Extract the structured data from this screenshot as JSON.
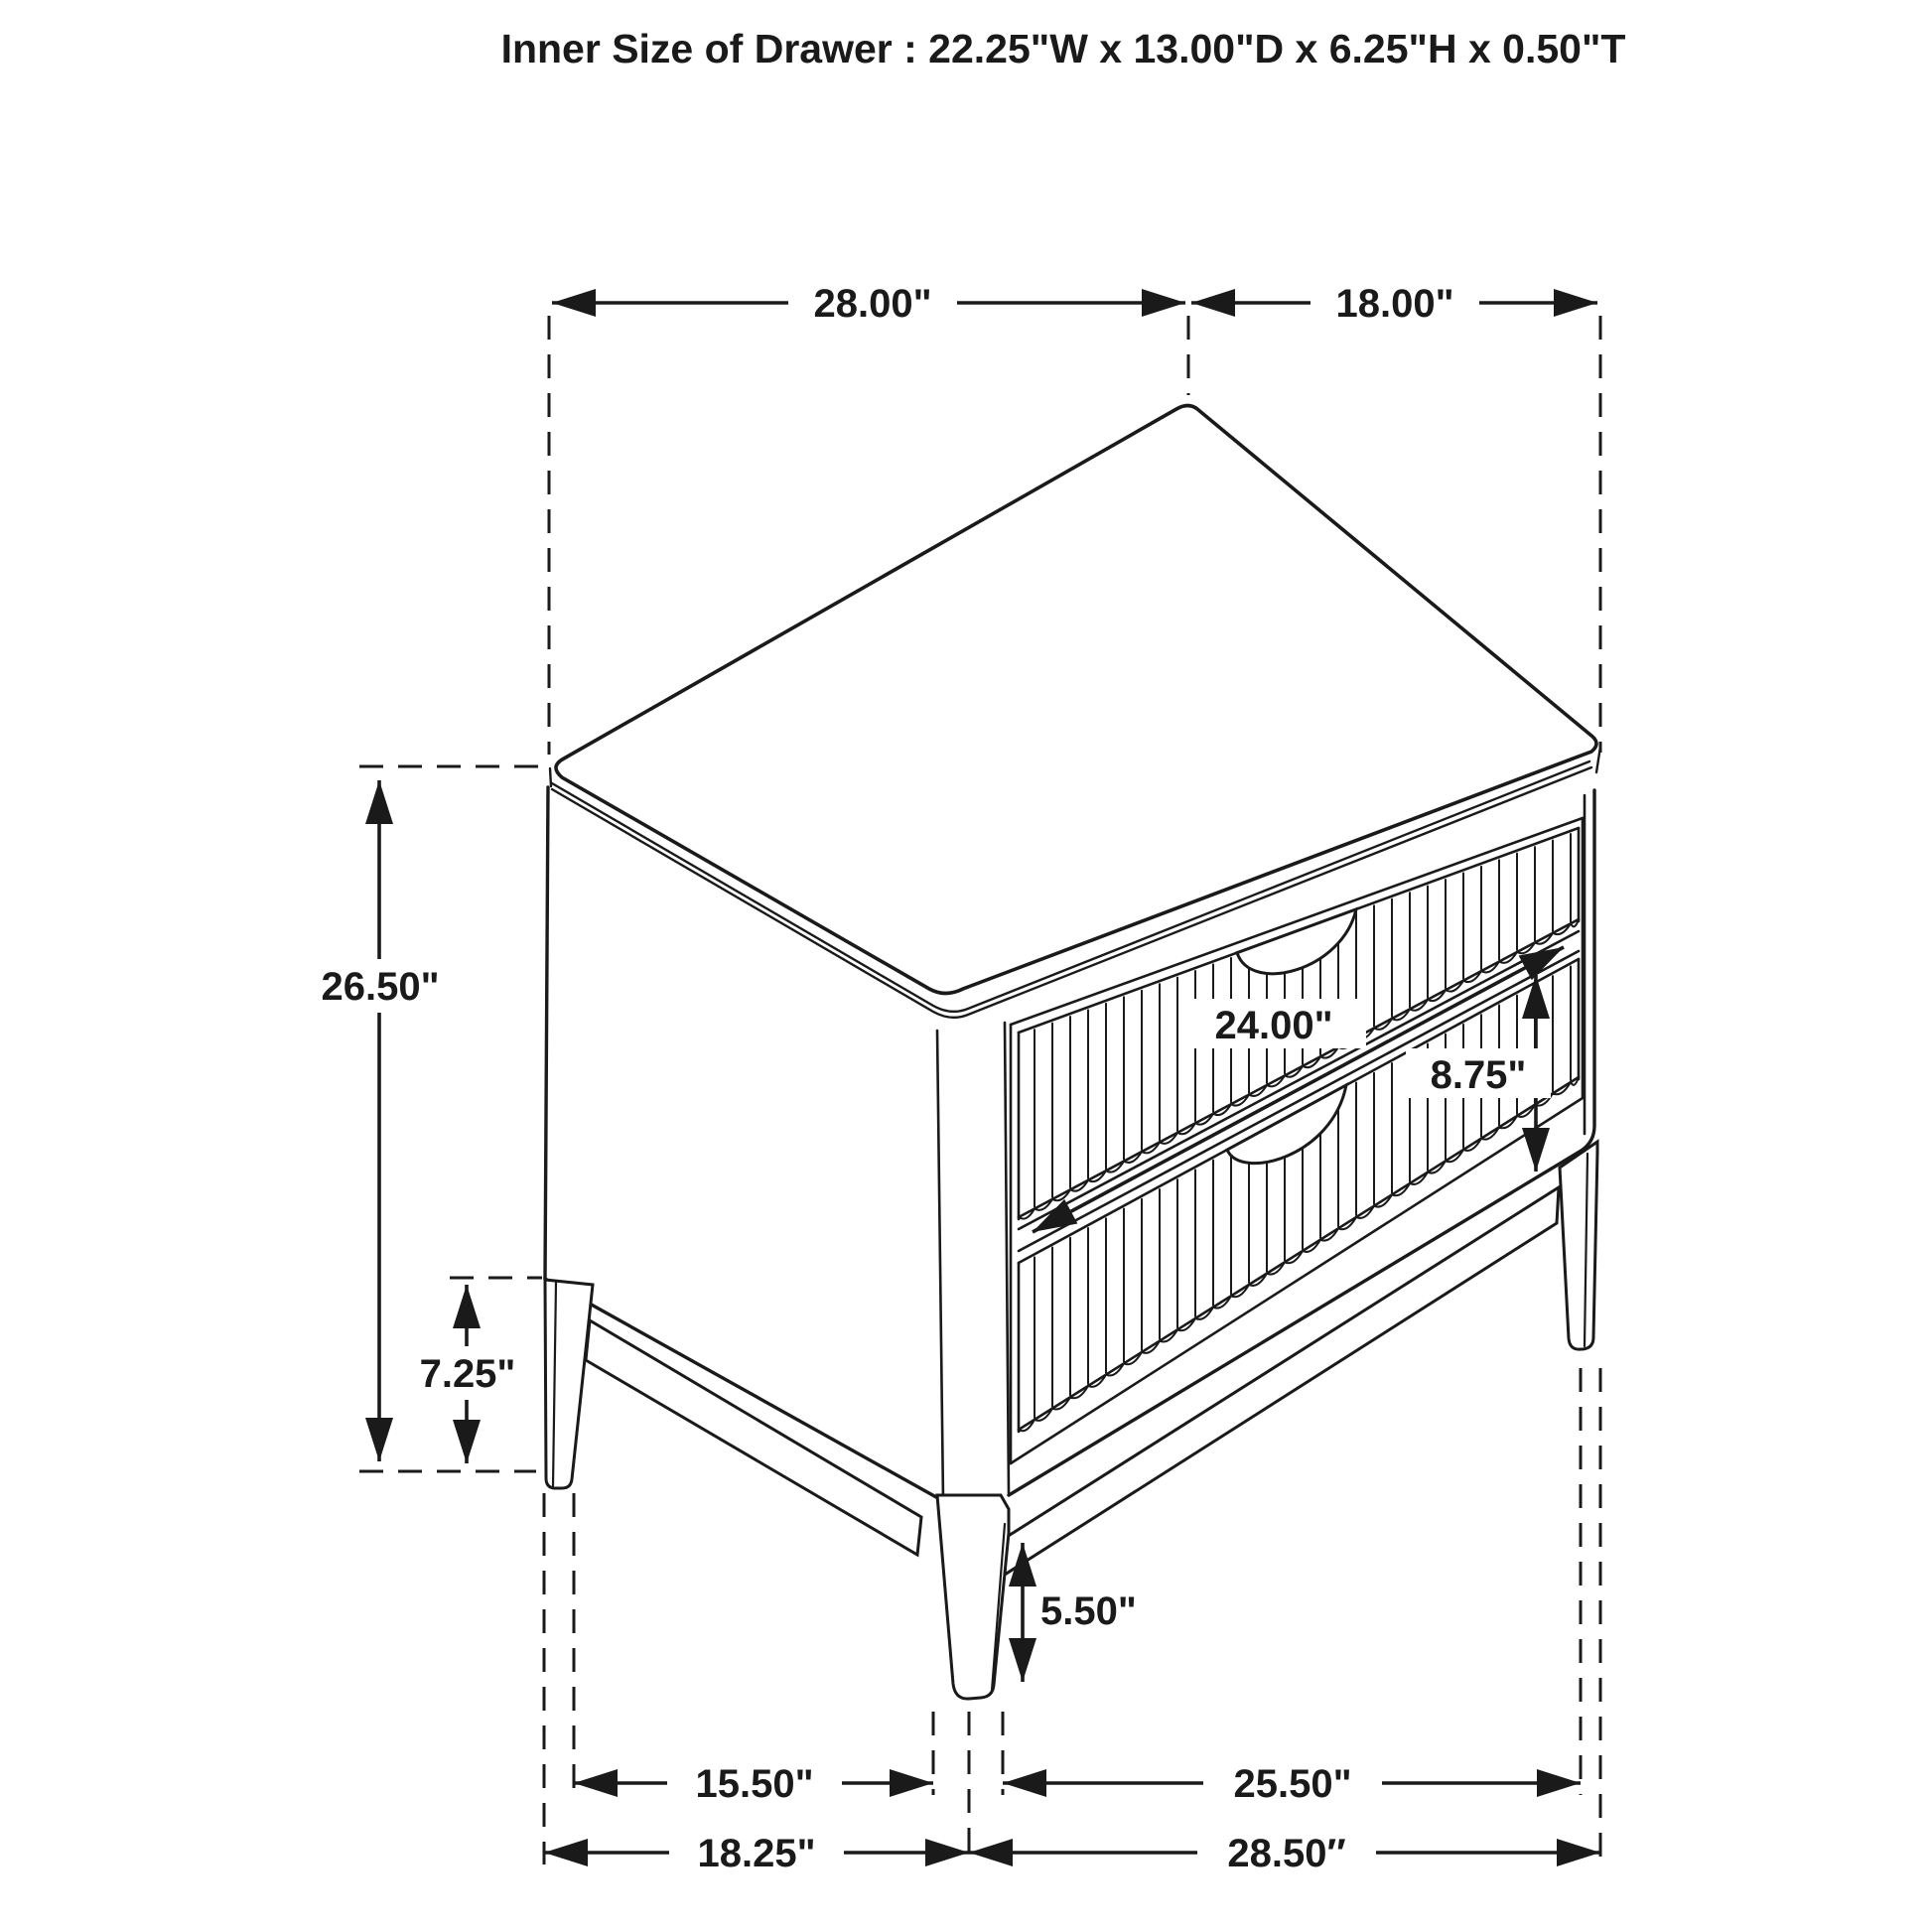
{
  "title": "Inner Size of Drawer : 22.25\"W x 13.00\"D x 6.25\"H x 0.50\"T",
  "diagram": {
    "type": "furniture-dimension-drawing",
    "subject": "two-drawer nightstand isometric line drawing",
    "units": "inches",
    "colors": {
      "ink": "#1a1a1a",
      "background": "#ffffff"
    },
    "inner_drawer": {
      "width": "22.25\"W",
      "depth": "13.00\"D",
      "height": "6.25\"H",
      "thickness": "0.50\"T"
    },
    "labels": {
      "top_width": "28.00\"",
      "top_depth": "18.00\"",
      "overall_height": "26.50\"",
      "back_leg_height": "7.25\"",
      "drawer_width": "24.00\"",
      "drawer_front_height": "8.75\"",
      "front_leg_height": "5.50\"",
      "side_feet_inner_span": "15.50\"",
      "front_feet_inner_span": "25.50\"",
      "side_feet_outer_span": "18.25\"",
      "front_feet_outer_span": "28.50″"
    }
  }
}
